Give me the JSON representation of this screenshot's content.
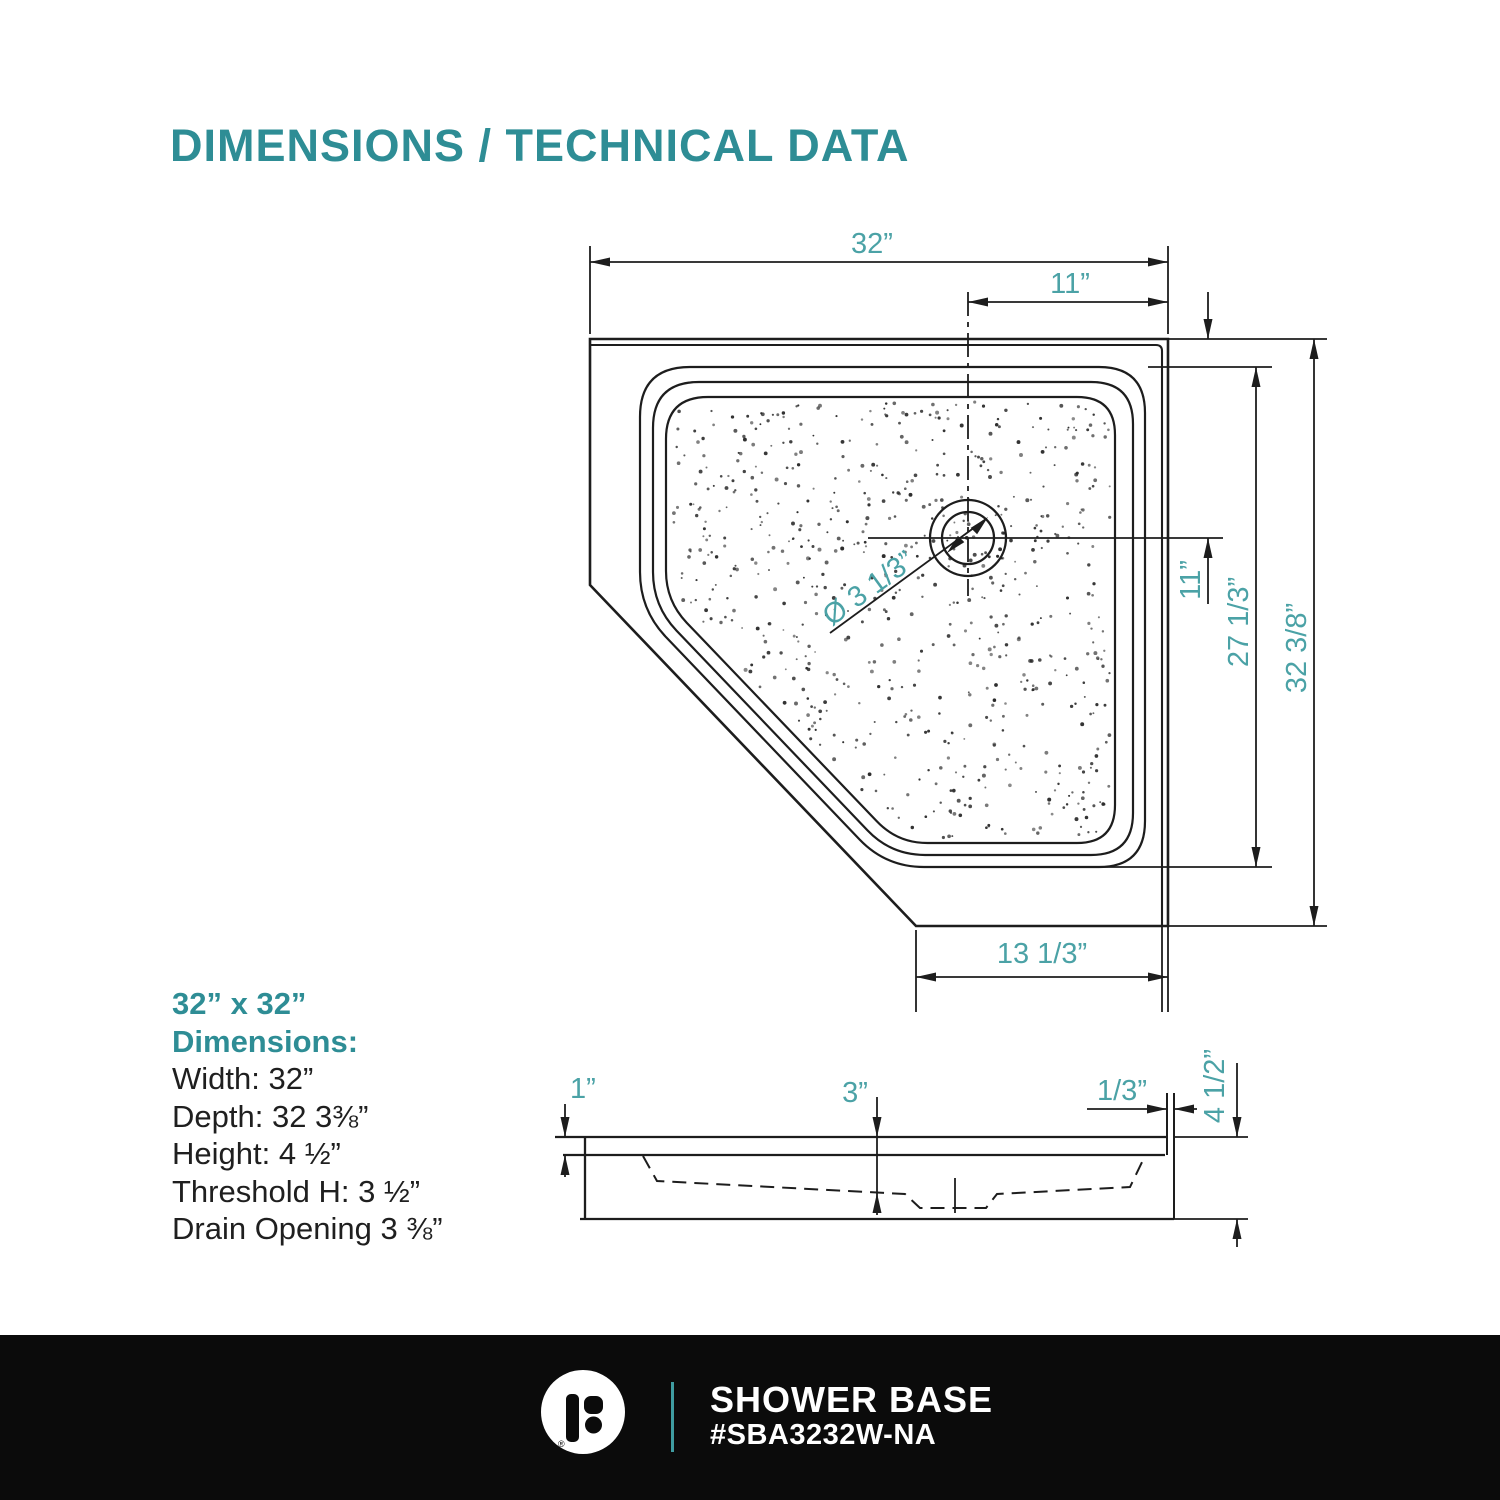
{
  "title": "DIMENSIONS / TECHNICAL DATA",
  "colors": {
    "teal_heading": "#2e8d95",
    "teal_dim": "#4ba2a6",
    "line": "#1d1d1d",
    "footer_bg": "#0b0b0b"
  },
  "top_view": {
    "width": "32”",
    "drain_offset_top": "11”",
    "drain_offset_right": "11”",
    "inner_depth": "27 1/3”",
    "depth": "32 3/8”",
    "bottom_edge": "13 1/3”",
    "drain_diameter": "Ø 3 1/3”"
  },
  "side_view": {
    "rim": "1”",
    "basin_depth": "3”",
    "lip": "1/3”",
    "height": "4 1/2”"
  },
  "specs": {
    "size": "32” x 32”",
    "heading": "Dimensions:",
    "lines": [
      "Width: 32”",
      "Depth: 32 3⅜”",
      "Height: 4 ½”",
      "Threshold H: 3 ½”",
      "Drain Opening 3 ⅜”"
    ]
  },
  "footer": {
    "product": "SHOWER BASE",
    "sku": "#SBA3232W-NA",
    "registered": "®"
  }
}
